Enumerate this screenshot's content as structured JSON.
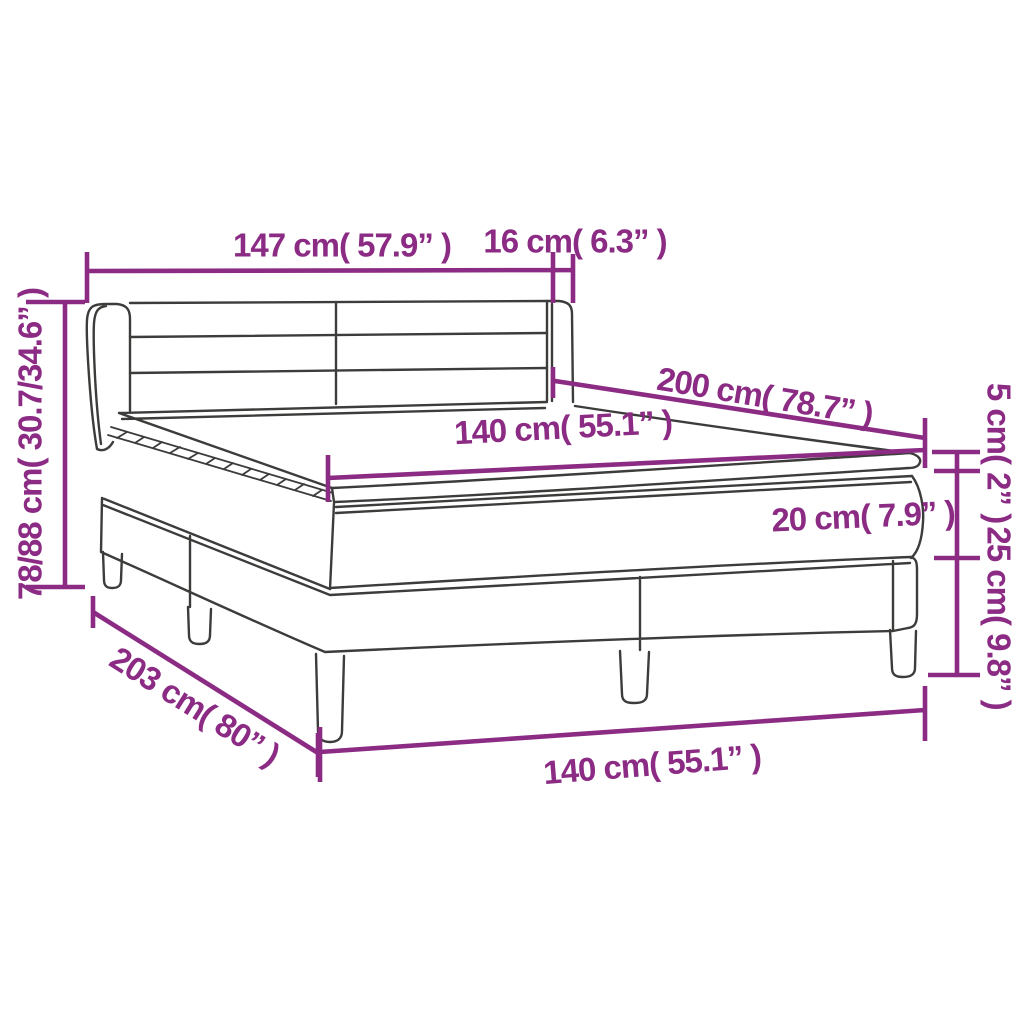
{
  "diagram": {
    "title": "box spring bed dimension diagram",
    "colors": {
      "outline": "#3C3C3B",
      "dimension": "#8B2B84",
      "background": "#FFFFFF"
    },
    "labels": {
      "headboard_width": "147 cm( 57.9” )",
      "side_panel_depth": "16 cm( 6.3” )",
      "overall_height": "78/88 cm( 30.7/34.6” )",
      "sleeping_length": "200 cm( 78.7” )",
      "sleeping_width": "140 cm( 55.1” )",
      "topper_thickness": "5 cm( 2” )",
      "mattress_thickness": "20 cm( 7.9” )",
      "base_height": "25 cm( 9.8” )",
      "frame_length": "203 cm( 80” )",
      "frame_width": "140 cm( 55.1” )"
    }
  }
}
